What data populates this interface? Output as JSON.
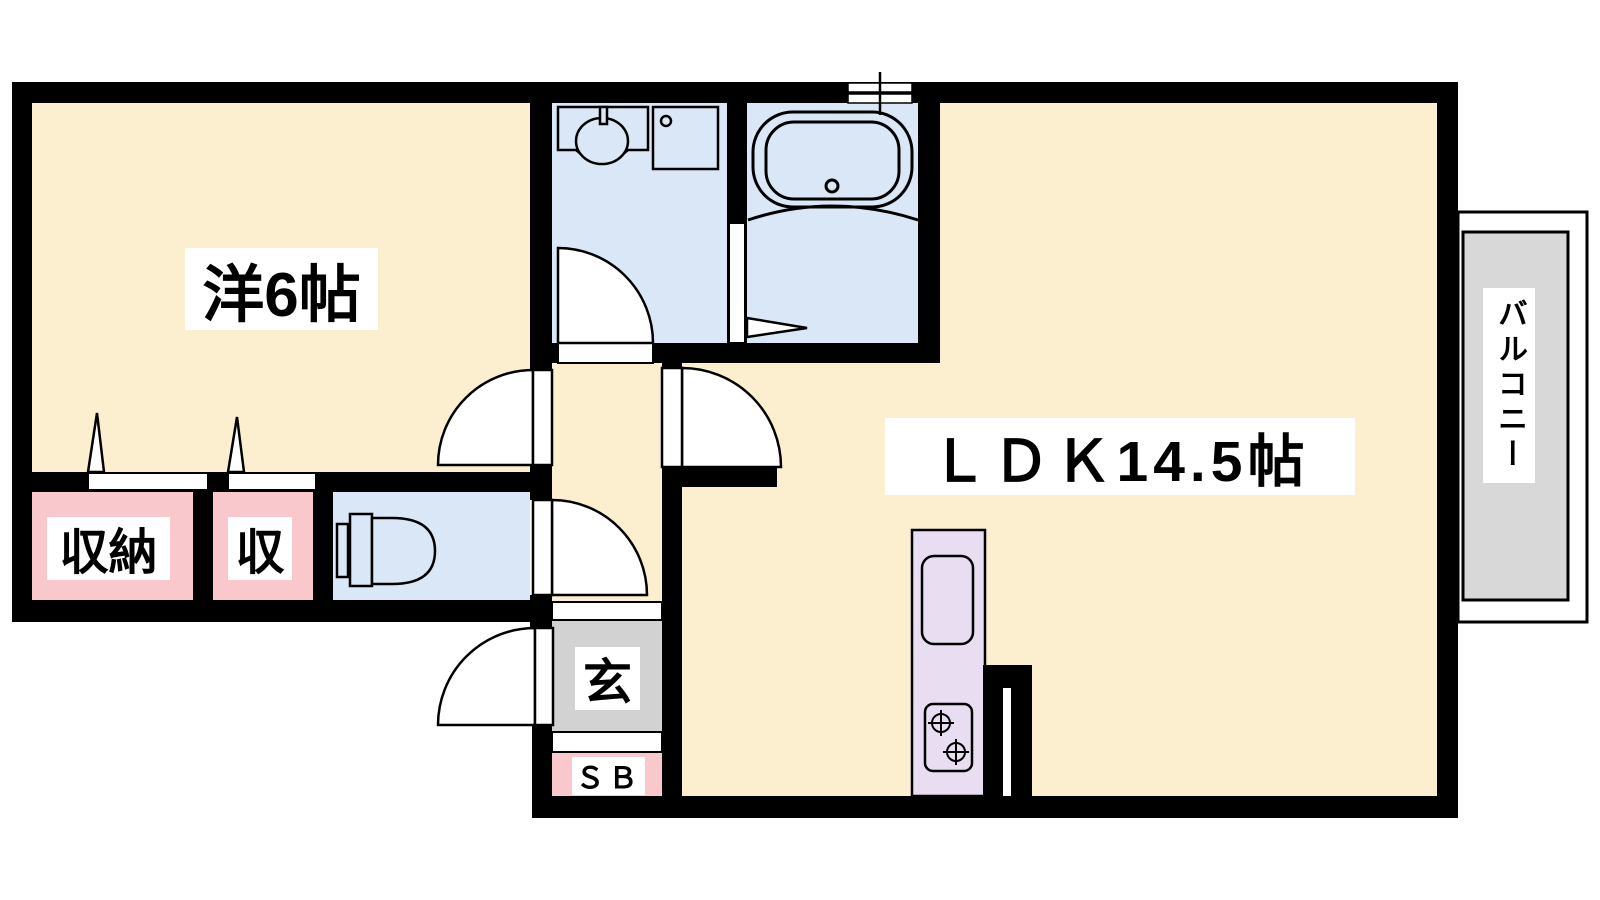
{
  "floor_plan": {
    "rooms": {
      "western_room": {
        "label": "洋6帖"
      },
      "ldk": {
        "label": "ＬＤＫ14.5帖"
      },
      "closet_large": {
        "label": "収納"
      },
      "closet_small": {
        "label": "収"
      },
      "entrance": {
        "label": "玄"
      },
      "shoe_box": {
        "label": "ＳＢ"
      },
      "balcony": {
        "label": "バルコニー"
      }
    },
    "colors": {
      "room_cream": "#FBEFCF",
      "wet_area_blue": "#DAE7F7",
      "closet_pink": "#F9C8CC",
      "entrance_gray": "#D2D2D2",
      "balcony_gray": "#D8D8D8",
      "kitchen_lavender": "#E9DDF1",
      "wall_black": "#000000",
      "fixture_line": "#000000"
    }
  }
}
